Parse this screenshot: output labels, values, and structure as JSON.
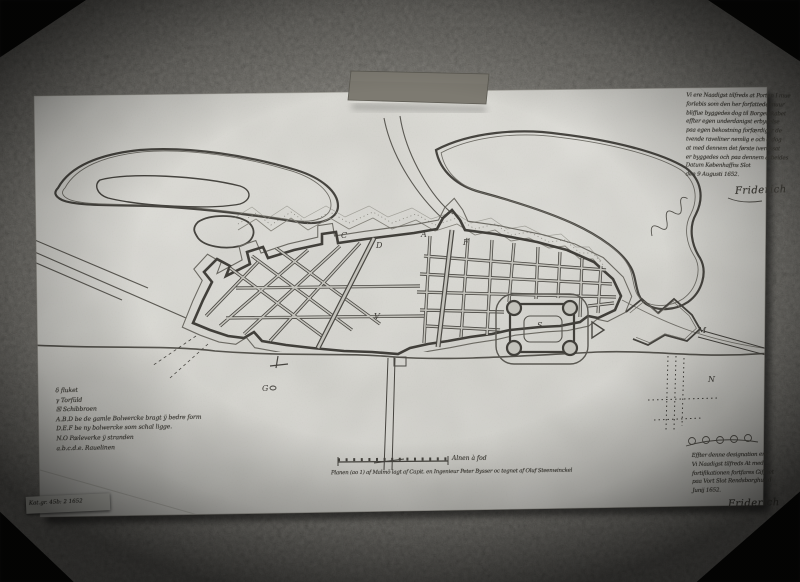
{
  "sticker": {
    "text": "Kat.gr. 45b: 2 1652"
  },
  "notes": {
    "top_right": {
      "lines": [
        "Vi ere Naadigst tilfreds at Porten I mue",
        "forlebis som den her forfattede muur",
        "bliffue byggedes dog til Borgerskabet",
        "effter egen underdanigst erbydelse",
        "paa egen bekostning forfærdiger de",
        "tvende raveliner nemlig e och d dog",
        "at med dennem det første ivercksat",
        "er byggedes och paa dennem arbeides",
        "Datum Københaffns Slot",
        "den 9 Augusti 1652."
      ],
      "signature": "Friderich"
    },
    "bottom_right": {
      "lines": [
        "Effter denne designation ere",
        "Vi Naadigst tilfreds At med",
        "fortifikationen fortfares Giffuet",
        "paa Vort Slot Rendsborghus d",
        "Junij 1652."
      ],
      "signature": "Friderich"
    }
  },
  "legend": {
    "lines": [
      "δ  fluket",
      "γ  Torfüld",
      "☒  Schibbroen",
      "A.B.D be de gamle Bolwercke bragt ÿ bedre form",
      "D.E.F be ny bolwercke som schal ligge.",
      "N.O Pæleverke ÿ stranden",
      "a.b.c.d.e. Rauelinen"
    ]
  },
  "scale": {
    "bar_label": "Alnen à fod",
    "caption": "Planen (ao 1) af Malmö lagt af Capit. en Ingenieur Peter Bysser oc tegnet af Oluf Steenwinckel"
  },
  "plan_letters": [
    {
      "t": "C"
    },
    {
      "t": "D"
    },
    {
      "t": "A"
    },
    {
      "t": "F"
    },
    {
      "t": "V"
    },
    {
      "t": "S"
    },
    {
      "t": "G"
    },
    {
      "t": "M"
    },
    {
      "t": "N"
    }
  ]
}
